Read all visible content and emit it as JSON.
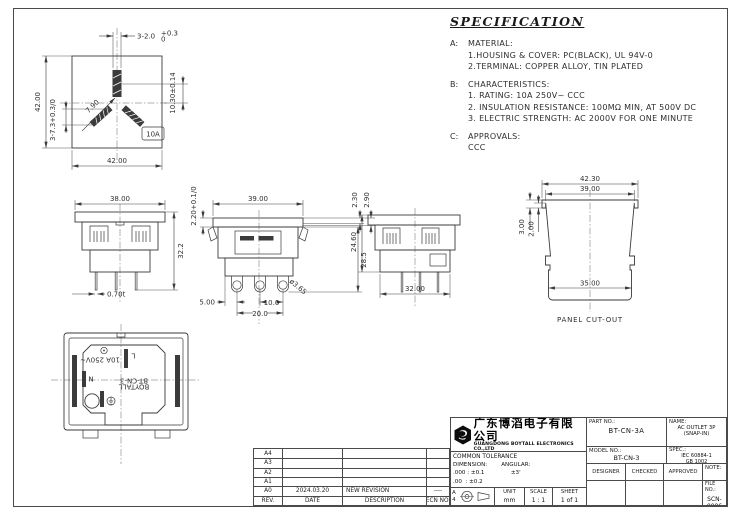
{
  "sheet": {
    "bg": "#ffffff",
    "line_color": "#3a3a3a",
    "frame_color": "#4a4a4a"
  },
  "spec": {
    "title": "SPECIFICATION",
    "sections": [
      {
        "key": "A:",
        "heading": "MATERIAL:",
        "lines": [
          "1.HOUSING & COVER: PC(BLACK), UL 94V-0",
          "2.TERMINAL: COPPER ALLOY, TIN PLATED"
        ]
      },
      {
        "key": "B:",
        "heading": "CHARACTERISTICS:",
        "lines": [
          "1. RATING: 10A 250V~ CCC",
          "2. INSULATION RESISTANCE: 100MΩ MIN, AT 500V DC",
          "3. ELECTRIC STRENGTH: AC 2000V FOR ONE MINUTE"
        ]
      },
      {
        "key": "C:",
        "heading": "APPROVALS:",
        "lines": [
          "CCC"
        ]
      }
    ]
  },
  "front_view": {
    "dim_slot_width_main": "3-2.0",
    "dim_slot_width_up": "+0.3",
    "dim_slot_width_dn": "0",
    "dim_earth_offset": "10.30±0.14",
    "dim_height": "42.00",
    "dim_slot_len": "3-7.3+0.3/0",
    "dim_angle": "7.90",
    "dim_width": "42.00",
    "badge": "10A"
  },
  "view38": {
    "dim_width": "38.00",
    "dim_height": "32.2",
    "dim_thickness": "0.70t"
  },
  "view39": {
    "dim_flange": "2.20+0.1/0",
    "dim_width": "39.00",
    "dim_tab1": "2.30",
    "dim_tab2": "2.90",
    "dim_height": "28.5",
    "dim_hole": "ø3.65",
    "dim_pin_offset": "5.00",
    "dim_pin_pitch": "10.0",
    "dim_pin_span": "20.0"
  },
  "view32": {
    "dim_height": "24.60",
    "dim_width": "32.00"
  },
  "panel_cutout": {
    "dim_outer": "42.30",
    "dim_inner": "39.00",
    "dim_step_outer": "3.00",
    "dim_step_inner": "2.00",
    "dim_bottom": "35.00",
    "caption": "PANEL CUT-OUT"
  },
  "rear_view": {
    "rating": "10A 250V~",
    "line": "L",
    "neutral": "N",
    "brand": "BOYTALL",
    "model": "BT-CN-3"
  },
  "revision_table": {
    "headers": [
      "REV.",
      "DATE",
      "DESCRIPTION",
      "ECN NO."
    ],
    "rows": [
      {
        "rev": "A4",
        "date": "",
        "description": "",
        "ecn": ""
      },
      {
        "rev": "A3",
        "date": "",
        "description": "",
        "ecn": ""
      },
      {
        "rev": "A2",
        "date": "",
        "description": "",
        "ecn": ""
      },
      {
        "rev": "A1",
        "date": "",
        "description": "",
        "ecn": ""
      },
      {
        "rev": "A0",
        "date": "2024.03.20",
        "description": "NEW REVISION",
        "ecn": "----"
      }
    ]
  },
  "title_block": {
    "company_cn": "广东博滔电子有限公司",
    "company_en": "GUANGDONG BOYTALL ELECTRONICS CO.,LTD",
    "part_no_label": "PART NO.:",
    "part_no": "BT-CN-3A",
    "name_label": "NAME:",
    "name_line1": "AC OUTLET 3P",
    "name_line2": "(SNAP-IN)",
    "model_no_label": "MODEL NO.:",
    "model_no": "BT-CN-3",
    "spec_label": "SPEC.:",
    "spec_line1": "IEC 60884-1",
    "spec_line2": "GB 1002",
    "designer_label": "DESIGNER",
    "checked_label": "CHECKED",
    "approved_label": "APPROVED",
    "note_label": "NOTE:",
    "tolerance_title": "COMMON TOLERANCE",
    "dimension_label": "DIMENSION:",
    "angular_label": "ANGULAR:",
    "tol_000": ".000 : ±0.1",
    "tol_00": ".00  : ±0.2",
    "tol_0": ".0    : ±0.3",
    "angular_tol": "±3'",
    "sheet_size_letter": "A",
    "sheet_size_num": "4",
    "unit_label": "UNIT",
    "unit": "mm",
    "scale_label": "SCALE",
    "scale": "1 : 1",
    "sheet_label": "SHEET",
    "sheet": "1 of 1",
    "file_label": "FILE NO.:",
    "file_no": "SCN-0006"
  }
}
